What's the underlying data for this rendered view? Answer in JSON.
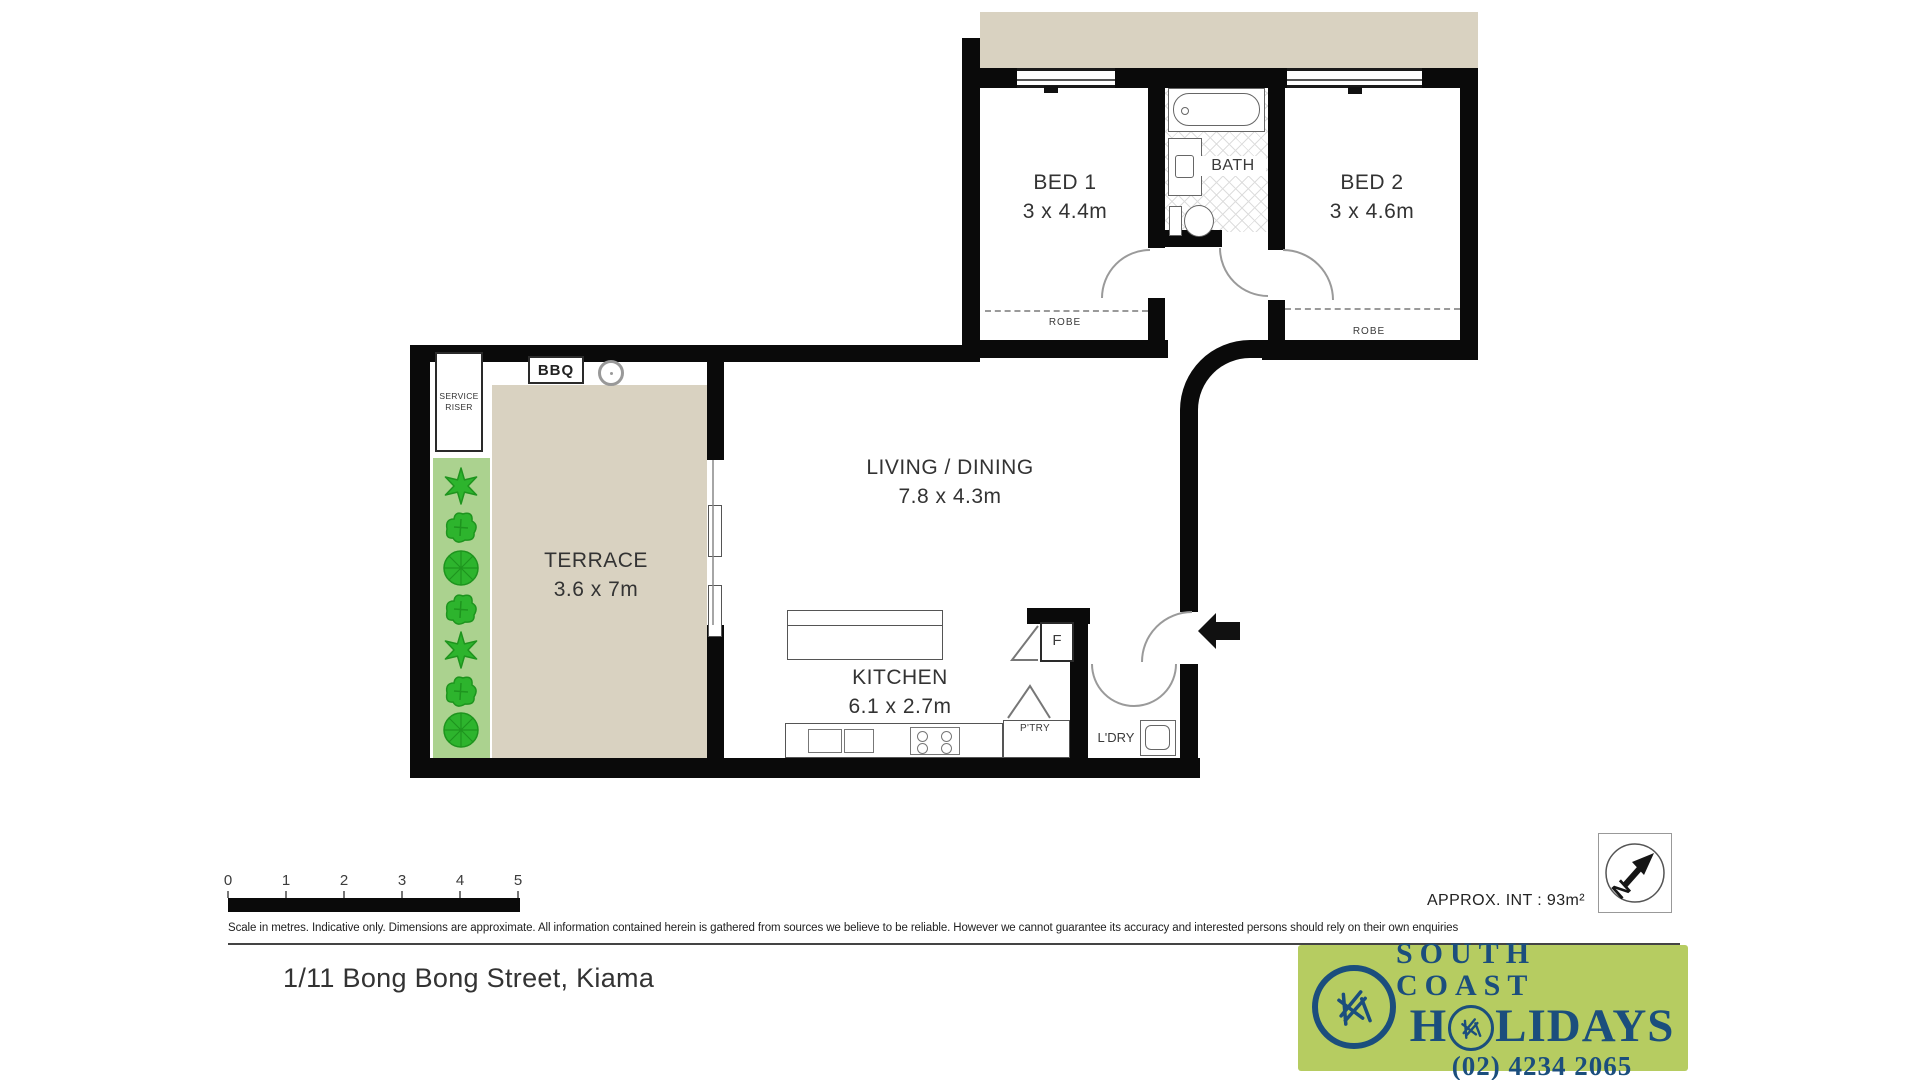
{
  "plan": {
    "rooms": {
      "bed1": {
        "label": "BED 1",
        "dims": "3 x 4.4m"
      },
      "bed2": {
        "label": "BED 2",
        "dims": "3 x 4.6m"
      },
      "bath": {
        "label": "BATH"
      },
      "living": {
        "label": "LIVING / DINING",
        "dims": "7.8 x 4.3m"
      },
      "kitchen": {
        "label": "KITCHEN",
        "dims": "6.1 x 2.7m"
      },
      "terrace": {
        "label": "TERRACE",
        "dims": "3.6 x 7m"
      },
      "laundry": {
        "label": "L'DRY"
      },
      "pantry": {
        "label": "P'TRY"
      },
      "fridge": {
        "label": "F"
      },
      "bbq": {
        "label": "BBQ"
      },
      "robe": {
        "label": "ROBE"
      },
      "service_riser": {
        "line1": "SERVICE",
        "line2": "RISER"
      }
    },
    "compass": {
      "letter": "N"
    },
    "scale_bar": {
      "ticks": [
        "0",
        "1",
        "2",
        "3",
        "4",
        "5"
      ]
    },
    "approx_int": "APPROX. INT : 93m²",
    "disclaimer": "Scale in metres. Indicative only. Dimensions are approximate. All information contained herein is gathered from sources we believe to be reliable. However we cannot guarantee its accuracy and interested persons should rely on their own enquiries",
    "plants": [
      "star",
      "bush",
      "round",
      "bush",
      "star",
      "bush",
      "round"
    ]
  },
  "footer": {
    "address": "1/11 Bong Bong Street, Kiama",
    "logo": {
      "line1": "SOUTH COAST",
      "holidays_h": "H",
      "holidays_rest": "LIDAYS",
      "phone": "(02) 4234 2065"
    }
  },
  "colors": {
    "wall": "#0a0a0a",
    "floor_beige": "#d9d2c1",
    "planter_green": "#abd28f",
    "plant_green": "#2db42d",
    "logo_green": "#b6cc61",
    "logo_blue": "#1b4e7d"
  }
}
